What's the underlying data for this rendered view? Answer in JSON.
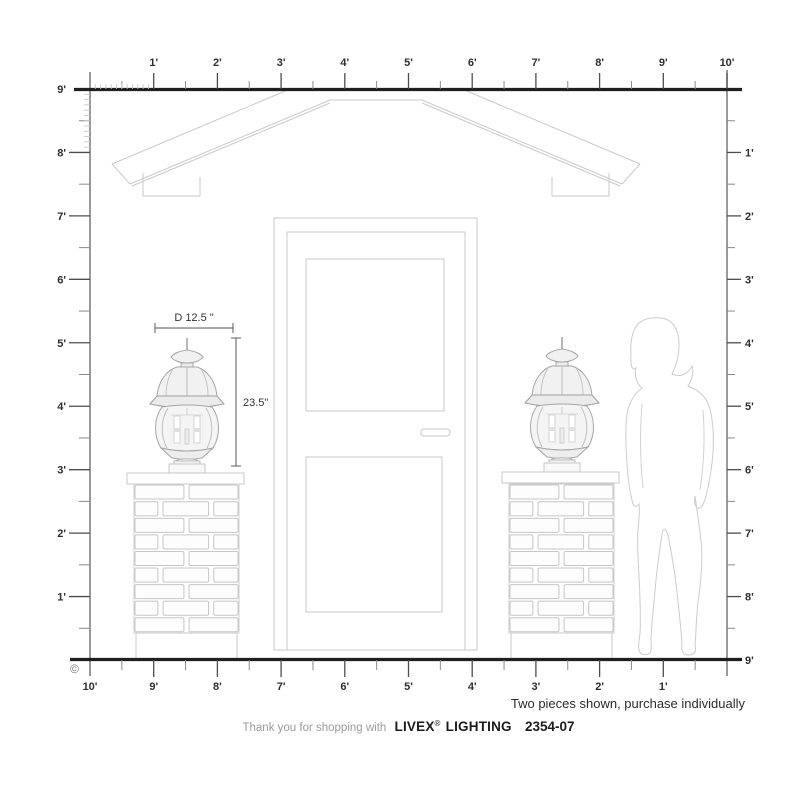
{
  "diagram_title": "Livex Lighting 2354-07 outdoor post lantern scale diagram",
  "scale": {
    "unit": "feet",
    "top_labels": [
      "1'",
      "2'",
      "3'",
      "4'",
      "5'",
      "6'",
      "7'",
      "8'",
      "9'",
      "10'"
    ],
    "bottom_labels": [
      "10'",
      "9'",
      "8'",
      "7'",
      "6'",
      "5'",
      "4'",
      "3'",
      "2'",
      "1'"
    ],
    "left_labels": [
      "9'",
      "8'",
      "7'",
      "6'",
      "5'",
      "4'",
      "3'",
      "2'",
      "1'"
    ],
    "right_labels": [
      "1'",
      "2'",
      "3'",
      "4'",
      "5'",
      "6'",
      "7'",
      "8'",
      "9'"
    ]
  },
  "annotations": {
    "diameter": "D 12.5 \"",
    "height": "23.5\"",
    "copyright": "©",
    "note": "Two pieces shown, purchase individually"
  },
  "footer": {
    "thank_you": "Thank you for shopping with",
    "brand": "LIVEX",
    "registered": "®",
    "brand_suffix": "LIGHTING",
    "model": "2354-07"
  },
  "scene": {
    "objects": [
      "gable roof",
      "front door",
      "left brick pillar with post lantern",
      "right brick pillar with post lantern",
      "woman silhouette for scale"
    ]
  },
  "colors": {
    "ink": "#1f1f1f",
    "ruler": "#6e6e6e",
    "tick": "#4d4d4d",
    "tickhalf": "#8a8a8a",
    "tickinch": "#c8c8c8",
    "label": "#2e2e2e",
    "draw": "#c9c9c9",
    "lant": "#a6a6a6",
    "dim": "#5a5a5a",
    "muted": "#9b9b9b"
  }
}
